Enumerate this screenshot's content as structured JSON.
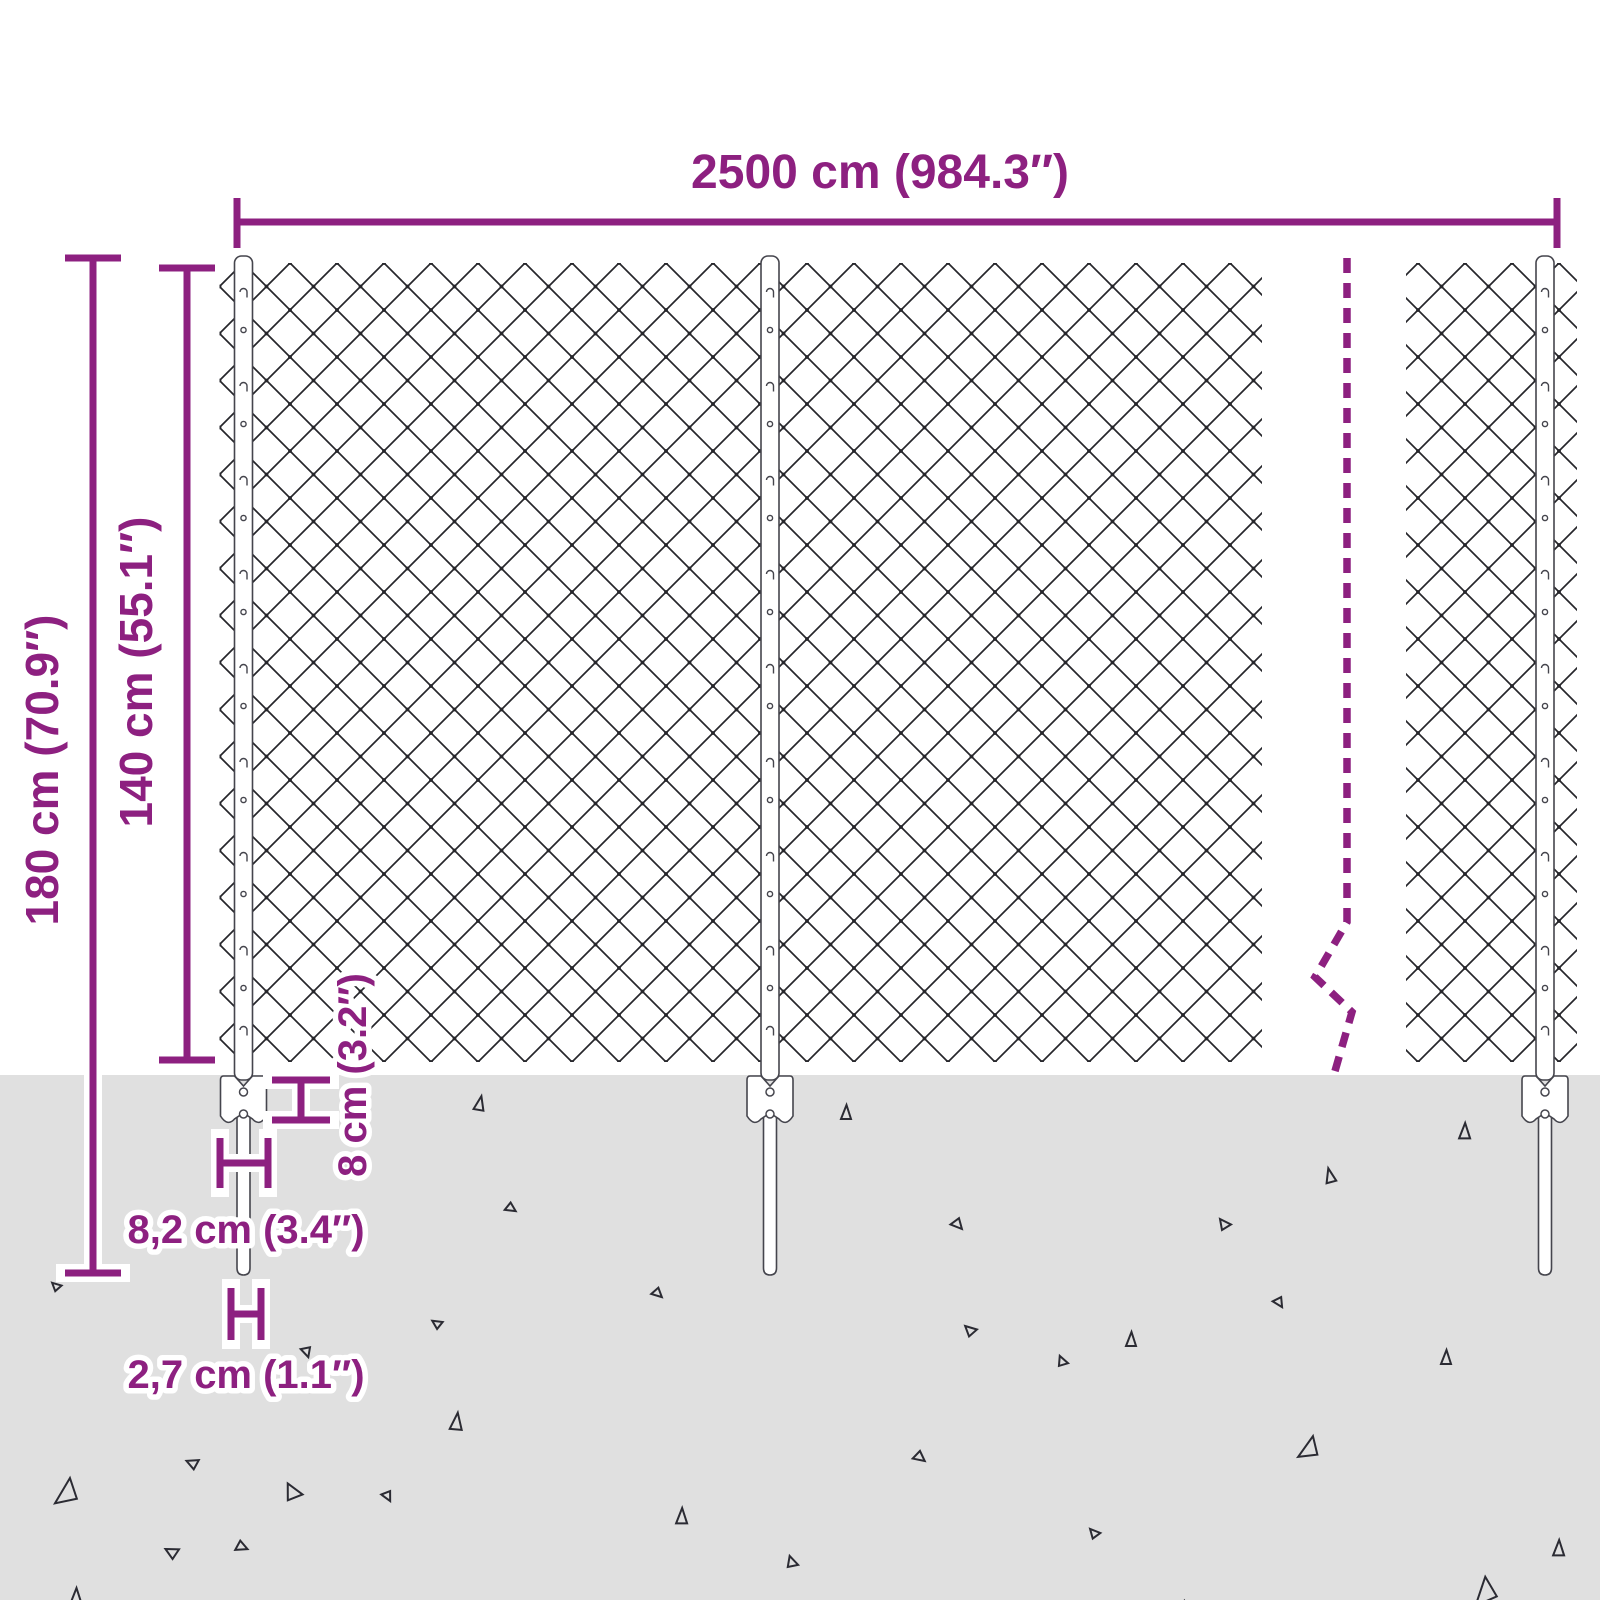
{
  "diagram": {
    "subject": "chain-link fence dimension diagram",
    "annotations": {
      "top_width": "2500 cm (984.3″)",
      "total_height": "180 cm (70.9″)",
      "mesh_height": "140 cm (55.1″)",
      "anchor_height": "8 cm (3.2″)",
      "anchor_width": "8,2 cm (3.4″)",
      "spike_width": "2,7 cm (1.1″)"
    },
    "colors": {
      "annotation": "#8d2080",
      "ground": "#e0e0e0",
      "mesh_line": "#26262b",
      "stone_outline": "#2b2b33",
      "post_fill": "#ffffff"
    }
  }
}
